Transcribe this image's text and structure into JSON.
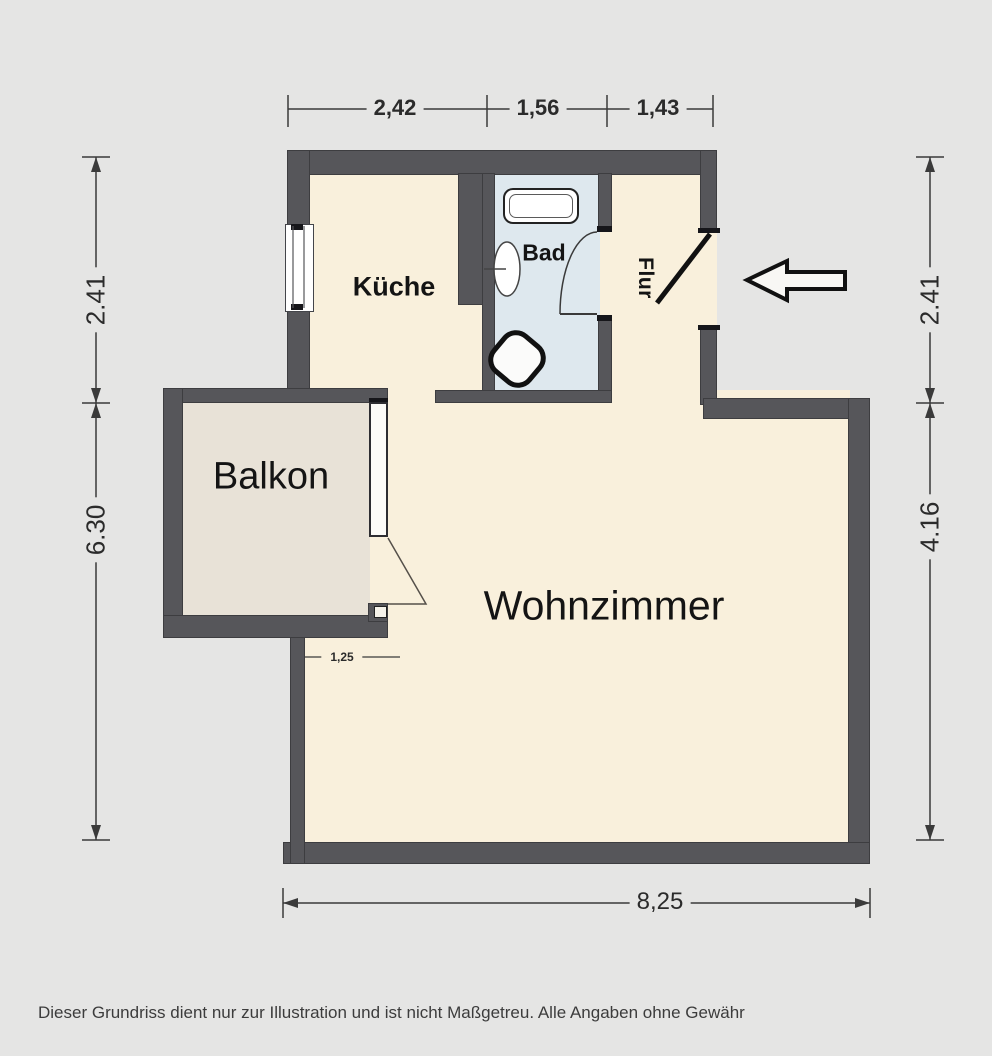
{
  "disclaimer": "Dieser Grundriss dient nur zur Illustration und ist nicht Maßgetreu. Alle Angaben ohne Gewähr",
  "rooms": {
    "kueche": {
      "label": "Küche"
    },
    "bad": {
      "label": "Bad"
    },
    "flur": {
      "label": "Flur"
    },
    "balkon": {
      "label": "Balkon"
    },
    "wohnzimmer": {
      "label": "Wohnzimmer"
    }
  },
  "dims": {
    "top": [
      "2,42",
      "1,56",
      "1,43"
    ],
    "left": [
      "2.41",
      "6.30"
    ],
    "right": [
      "2.41",
      "4.16"
    ],
    "bottom": "8,25",
    "step": "1,25"
  },
  "colors": {
    "background": "#e5e5e4",
    "wall": "#56565a",
    "floor": "#f9f0dc",
    "bath_floor": "#dee8ee",
    "balcony_floor": "#e8e2d7",
    "linework": "#333333"
  },
  "entrance": {
    "arrow_direction": "left"
  }
}
